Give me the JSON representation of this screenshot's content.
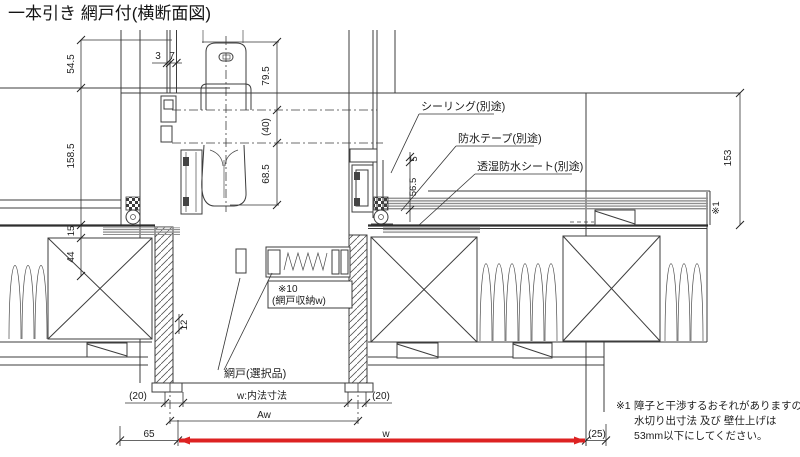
{
  "title": "一本引き 網戸付(横断面図)",
  "callouts": {
    "sealing": "シーリング(別途)",
    "tape": "防水テープ(別途)",
    "sheet": "透湿防水シート(別途)",
    "screen": "網戸(選択品)",
    "screen_storage_ref": "※10",
    "screen_storage": "(網戸収納w)",
    "wall_ref": "※1"
  },
  "dims": {
    "v54_5": "54.5",
    "v158_5": "158.5",
    "v15": "15",
    "v44": "44",
    "v12": "12",
    "t3": "3",
    "t7": "7",
    "h79_5": "79.5",
    "h40": "(40)",
    "h68_5": "68.5",
    "r5": "5",
    "r56_5": "56.5",
    "r153": "153",
    "b20_left": "(20)",
    "b20_right": "(20)",
    "w_inner": "w:内法寸法",
    "aw": "Aw",
    "b65": "65",
    "bw": "w",
    "b25": "(25)"
  },
  "note": {
    "ref": "※1",
    "line1": "障子と干渉するおそれがありますので",
    "line2": "水切り出寸法 及び 壁仕上げは",
    "line3": "53mm以下にしてください。"
  },
  "colors": {
    "line": "#3c3c3c",
    "highlight": "#dd2222",
    "siding": "#8f8f8f",
    "background": "#ffffff"
  }
}
